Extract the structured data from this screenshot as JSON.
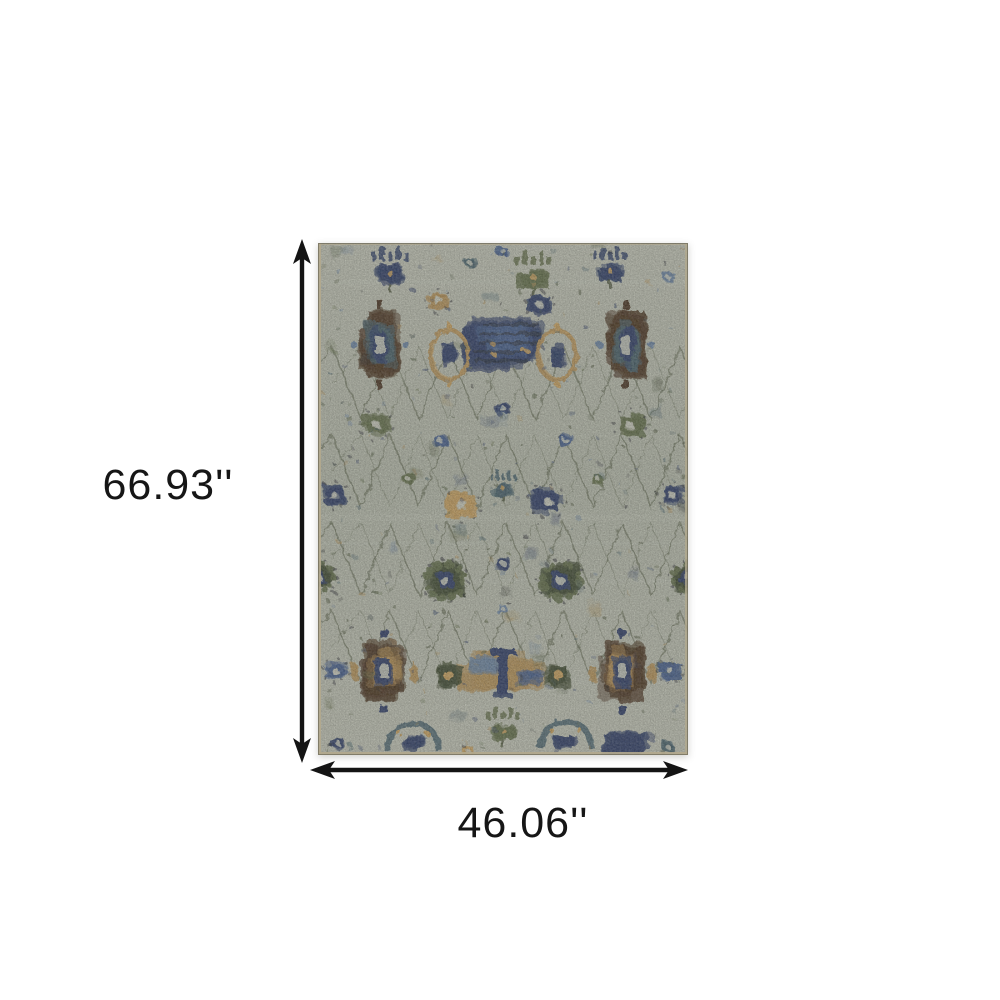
{
  "page": {
    "background_color": "#ffffff"
  },
  "annotation": {
    "height_label": "66.93''",
    "width_label": "46.06''",
    "arrow_color": "#141414",
    "label_color": "#161616"
  },
  "rug": {
    "style": "distressed traditional oriental all-over pattern",
    "palette": {
      "base": "#c5c8b9",
      "base_dark": "#b9beae",
      "core": "#cfd1c3",
      "navy": "#2e3e68",
      "blue": "#46608f",
      "steel": "#6d87a6",
      "teal": "#47626c",
      "olive": "#64704a",
      "dark_olive": "#414c31",
      "vine": "#4a5238",
      "brown": "#4c3520",
      "ink": "#24262a",
      "tan": "#b99559",
      "gold": "#cda45f",
      "edge": "#b2a98d"
    }
  }
}
